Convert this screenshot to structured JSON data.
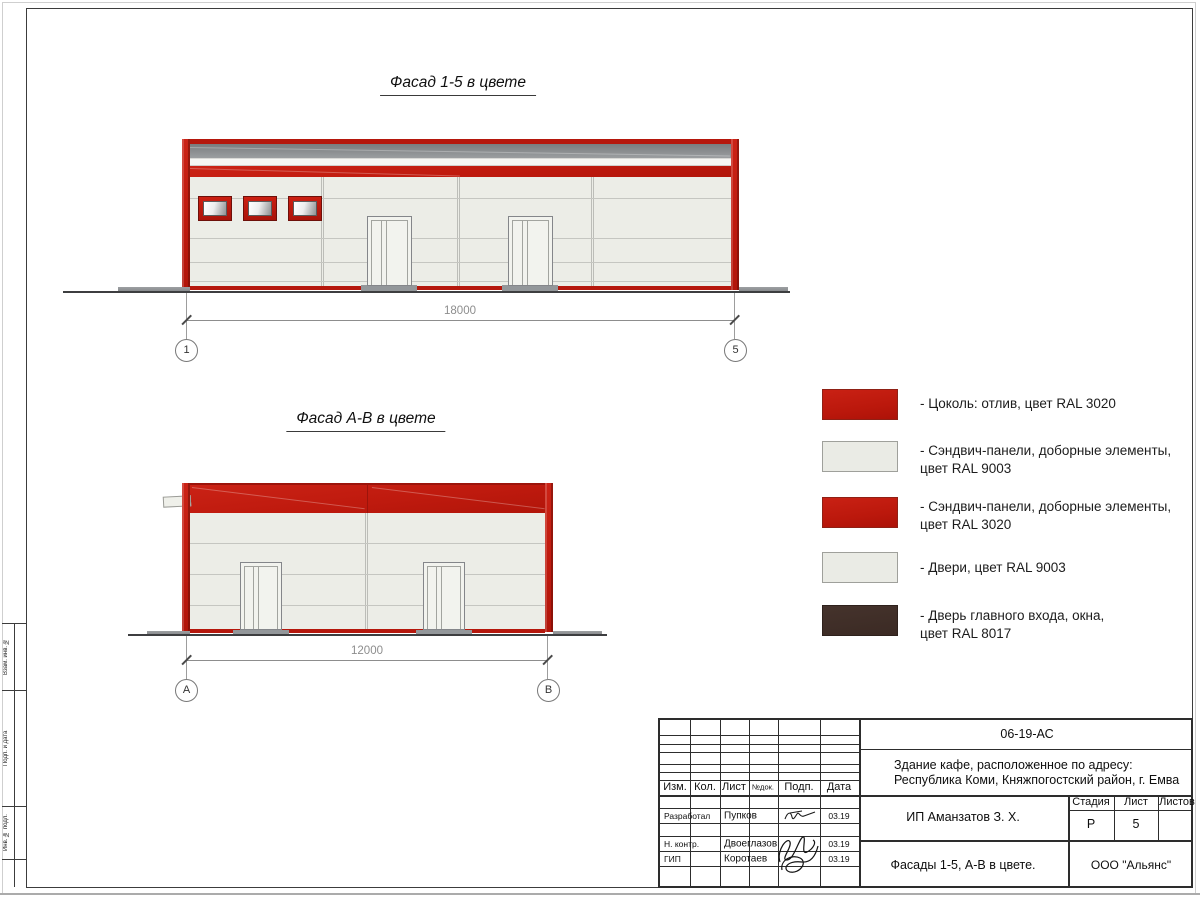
{
  "page": {
    "titles": {
      "facade_1_5": "Фасад 1-5 в цвете",
      "facade_a_b": "Фасад А-В в цвете"
    }
  },
  "facade_1_5": {
    "dimension": "18000",
    "axis_left": "1",
    "axis_right": "5"
  },
  "facade_a_b": {
    "dimension": "12000",
    "axis_left": "А",
    "axis_right": "В"
  },
  "legend": {
    "items": [
      {
        "swatch_color": "#c21a10",
        "line1": "- Цоколь: отлив, цвет RAL 3020",
        "line2": ""
      },
      {
        "swatch_color": "#ecede7",
        "line1": "- Сэндвич-панели, доборные элементы,",
        "line2": "цвет RAL 9003"
      },
      {
        "swatch_color": "#c21a10",
        "line1": "- Сэндвич-панели, доборные элементы,",
        "line2": "цвет RAL 3020"
      },
      {
        "swatch_color": "#ecede7",
        "line1": "- Двери, цвет RAL 9003",
        "line2": ""
      },
      {
        "swatch_color": "#3f2d26",
        "line1": "- Дверь главного входа, окна,",
        "line2": "цвет RAL 8017"
      }
    ]
  },
  "title_block": {
    "doc_number": "06-19-АС",
    "address_line1": "Здание кафе, расположенное по адресу:",
    "address_line2": "Республика Коми, Княжпогостский район, г. Емва",
    "client": "ИП Аманзатов З. Х.",
    "sheet_name": "Фасады 1-5, А-В в цвете.",
    "company": "ООО \"Альянс\"",
    "col_izm": "Изм.",
    "col_kol": "Кол.",
    "col_list": "Лист",
    "col_dok": "№док.",
    "col_podp": "Подп.",
    "col_data": "Дата",
    "stage_label": "Стадия",
    "list_label": "Лист",
    "listov_label": "Листов",
    "stage_value": "Р",
    "list_value": "5",
    "rows": [
      {
        "role": "Разработал",
        "name": "Пупков",
        "date": "03.19"
      },
      {
        "role": "Н. контр.",
        "name": "Двоеглазов",
        "date": "03.19"
      },
      {
        "role": "ГИП",
        "name": "Коротаев",
        "date": "03.19"
      }
    ]
  },
  "side_stamp": {
    "labels": [
      "Взам. инв. №",
      "Подп. и дата",
      "Инв. № подл."
    ]
  },
  "colors": {
    "ral_3020_red": "#c21a10",
    "ral_9003_white": "#ecede7",
    "ral_8017_brown": "#3f2d26"
  }
}
